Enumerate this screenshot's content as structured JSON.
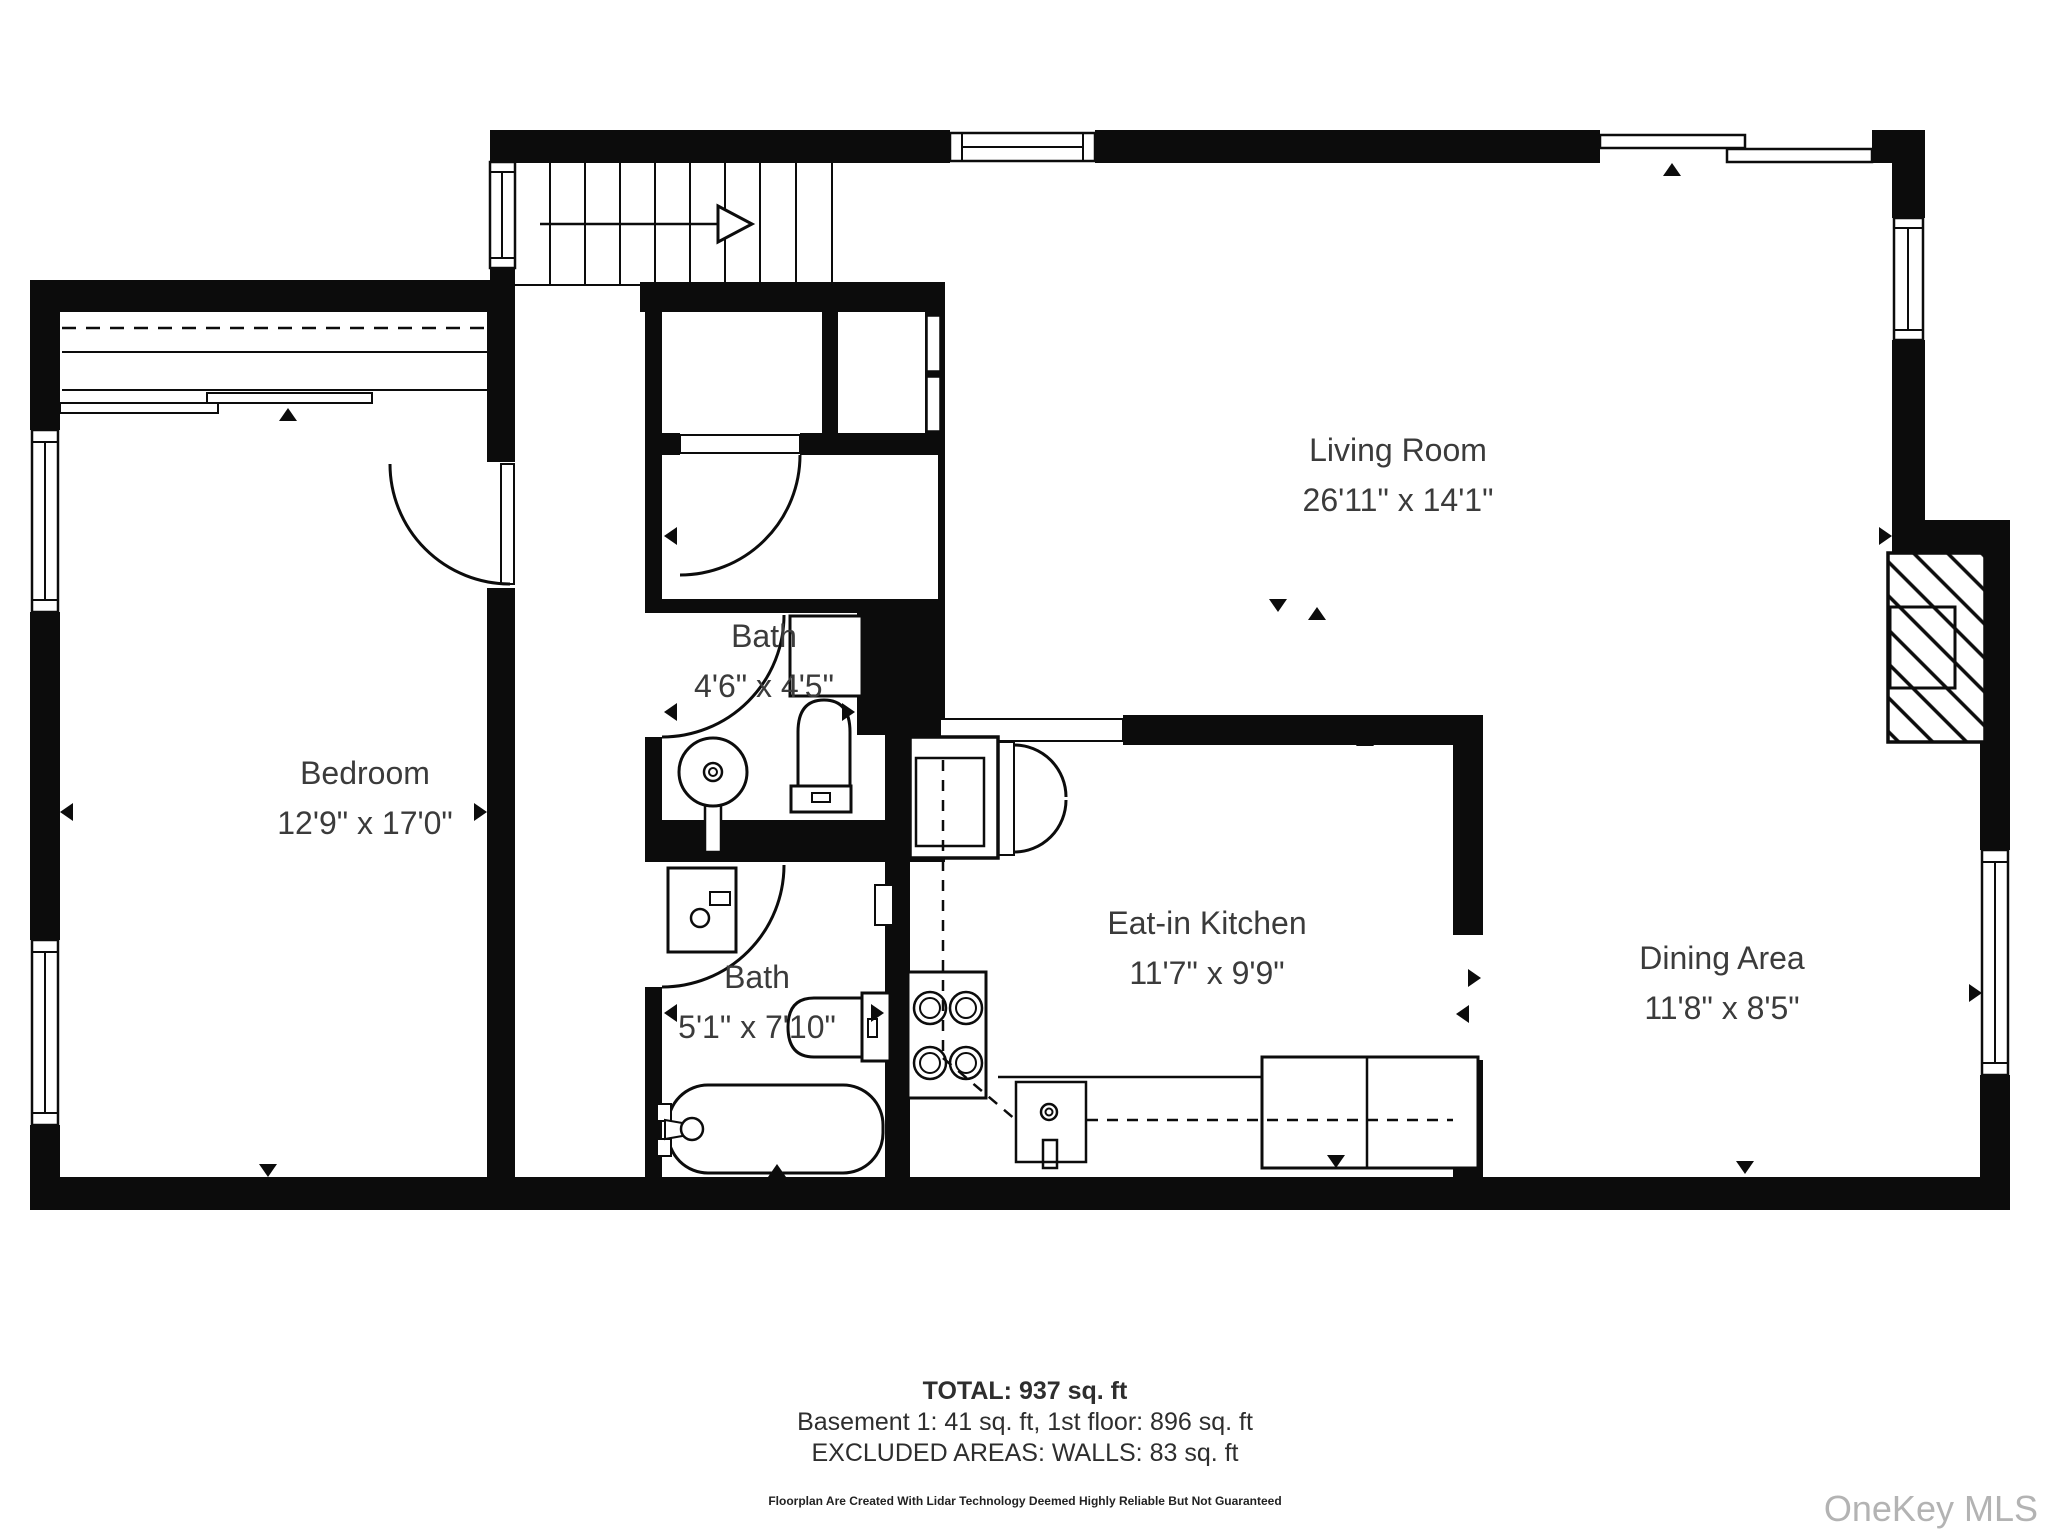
{
  "floorplan": {
    "rooms": [
      {
        "name": "Living Room",
        "dims": "26'11\" x 14'1\""
      },
      {
        "name": "Bedroom",
        "dims": "12'9\" x 17'0\""
      },
      {
        "name": "Bath",
        "dims": "4'6\" x 4'5\""
      },
      {
        "name": "Bath",
        "dims": "5'1\" x 7'10\""
      },
      {
        "name": "Eat-in Kitchen",
        "dims": "11'7\" x 9'9\""
      },
      {
        "name": "Dining Area",
        "dims": "11'8\" x 8'5\""
      }
    ],
    "summary": {
      "total": "TOTAL: 937 sq. ft",
      "breakdown": "Basement 1: 41 sq. ft, 1st floor: 896 sq. ft",
      "excluded": "EXCLUDED AREAS: WALLS: 83 sq. ft",
      "disclaimer": "Floorplan Are Created With Lidar Technology Deemed Highly Reliable But Not Guaranteed"
    },
    "watermark": "OneKey MLS",
    "colors": {
      "wall": "#0c0c0c",
      "text": "#3b3b3b",
      "watermark": "#b3b3b3"
    }
  }
}
